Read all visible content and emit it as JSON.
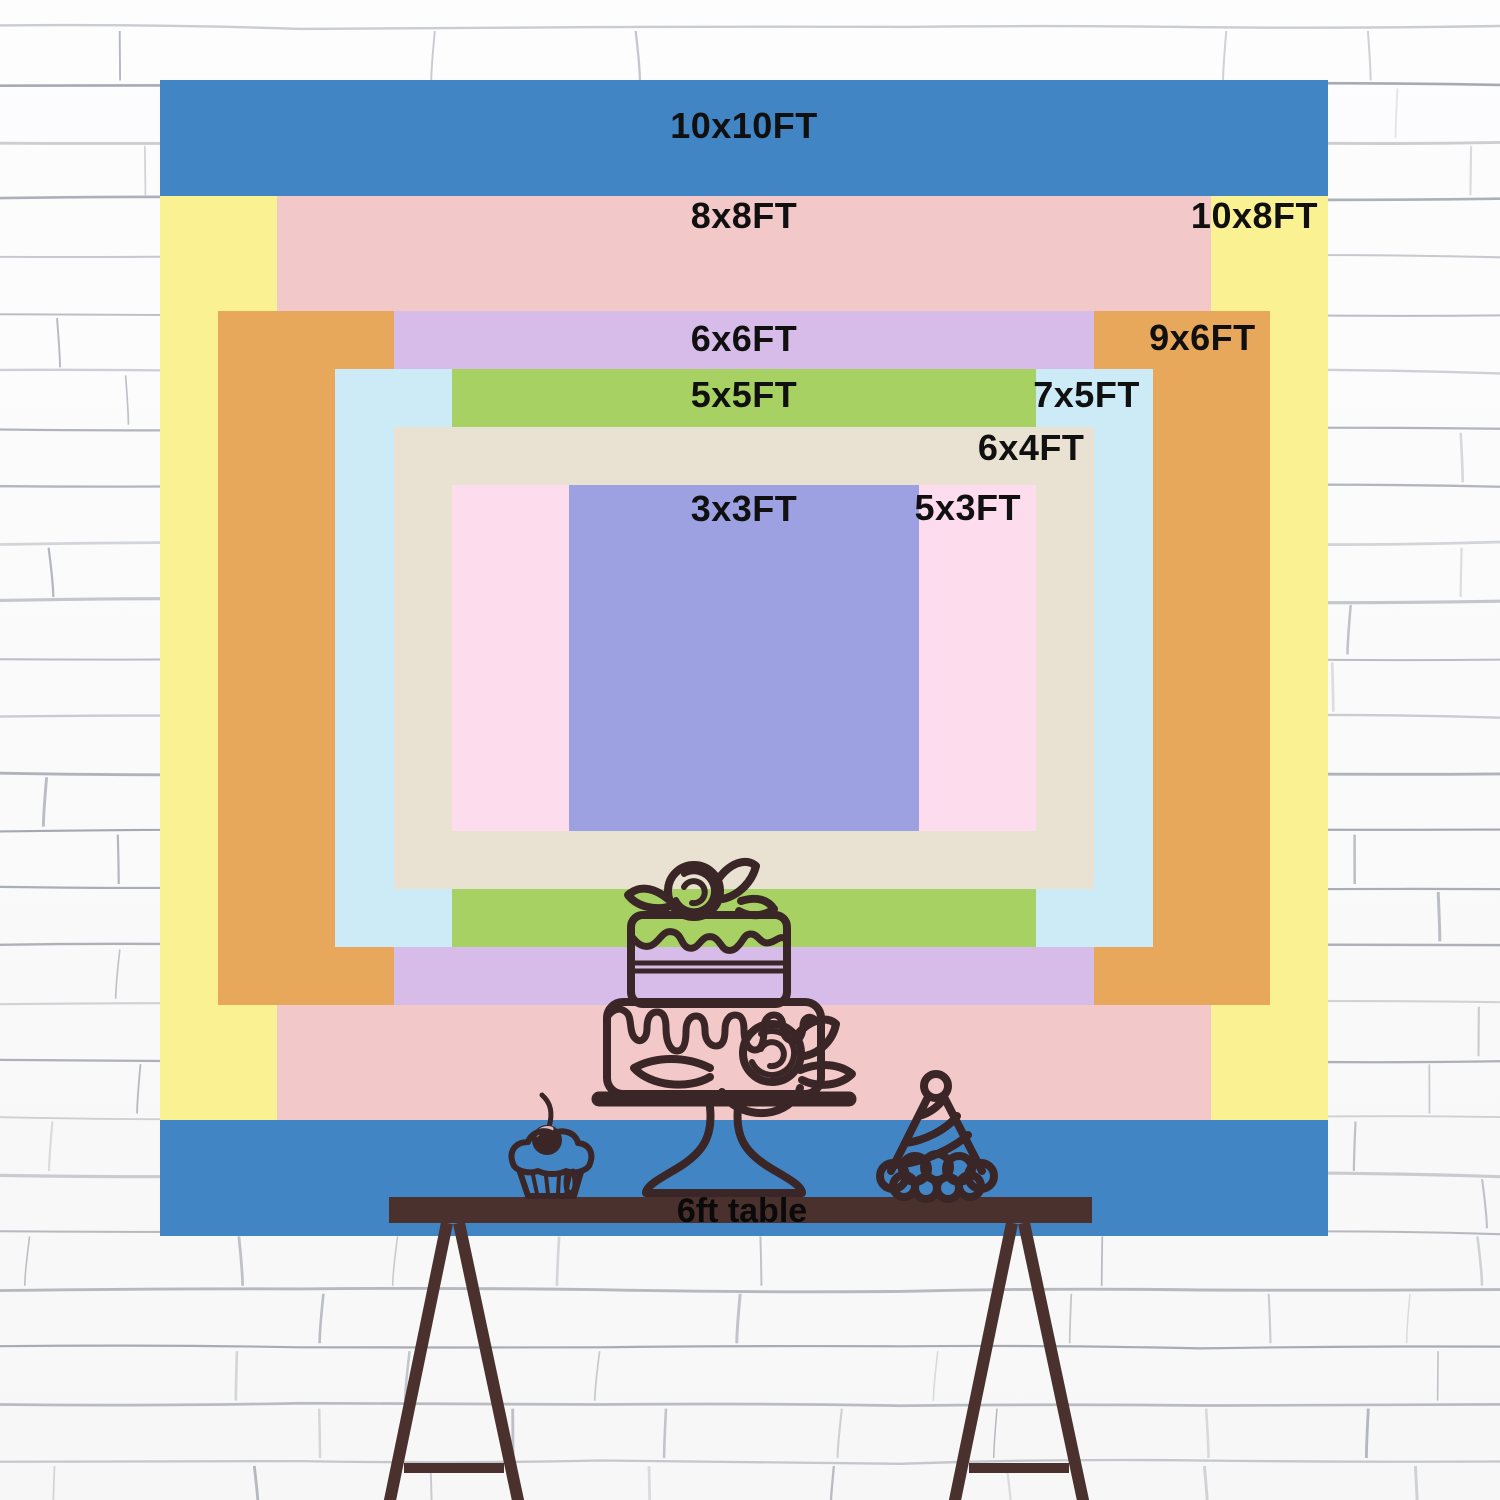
{
  "backdrop": {
    "unit": "FT",
    "sizes": [
      {
        "label": "10x10FT",
        "w_ft": 10,
        "h_ft": 10,
        "color": "#4285c5"
      },
      {
        "label": "10x8FT",
        "w_ft": 10,
        "h_ft": 8,
        "color": "#faf192"
      },
      {
        "label": "8x8FT",
        "w_ft": 8,
        "h_ft": 8,
        "color": "#f3c8c8"
      },
      {
        "label": "9x6FT",
        "w_ft": 9,
        "h_ft": 6,
        "color": "#e8a85c"
      },
      {
        "label": "6x6FT",
        "w_ft": 6,
        "h_ft": 6,
        "color": "#d7bce9"
      },
      {
        "label": "7x5FT",
        "w_ft": 7,
        "h_ft": 5,
        "color": "#cdeaf7"
      },
      {
        "label": "5x5FT",
        "w_ft": 5,
        "h_ft": 5,
        "color": "#a7d163"
      },
      {
        "label": "6x4FT",
        "w_ft": 6,
        "h_ft": 4,
        "color": "#e9e2d2"
      },
      {
        "label": "5x3FT",
        "w_ft": 5,
        "h_ft": 3,
        "color": "#fcdced"
      },
      {
        "label": "3x3FT",
        "w_ft": 3,
        "h_ft": 3,
        "color": "#9da1e2"
      }
    ]
  },
  "table": {
    "label": "6ft table",
    "color": "#4a312d"
  },
  "icons": {
    "cake": "two-tier-birthday-cake",
    "cupcake": "cupcake-with-cherry",
    "party_hat": "striped-party-hat"
  },
  "wall": {
    "style": "white-brick",
    "line_color": "#858b95"
  }
}
